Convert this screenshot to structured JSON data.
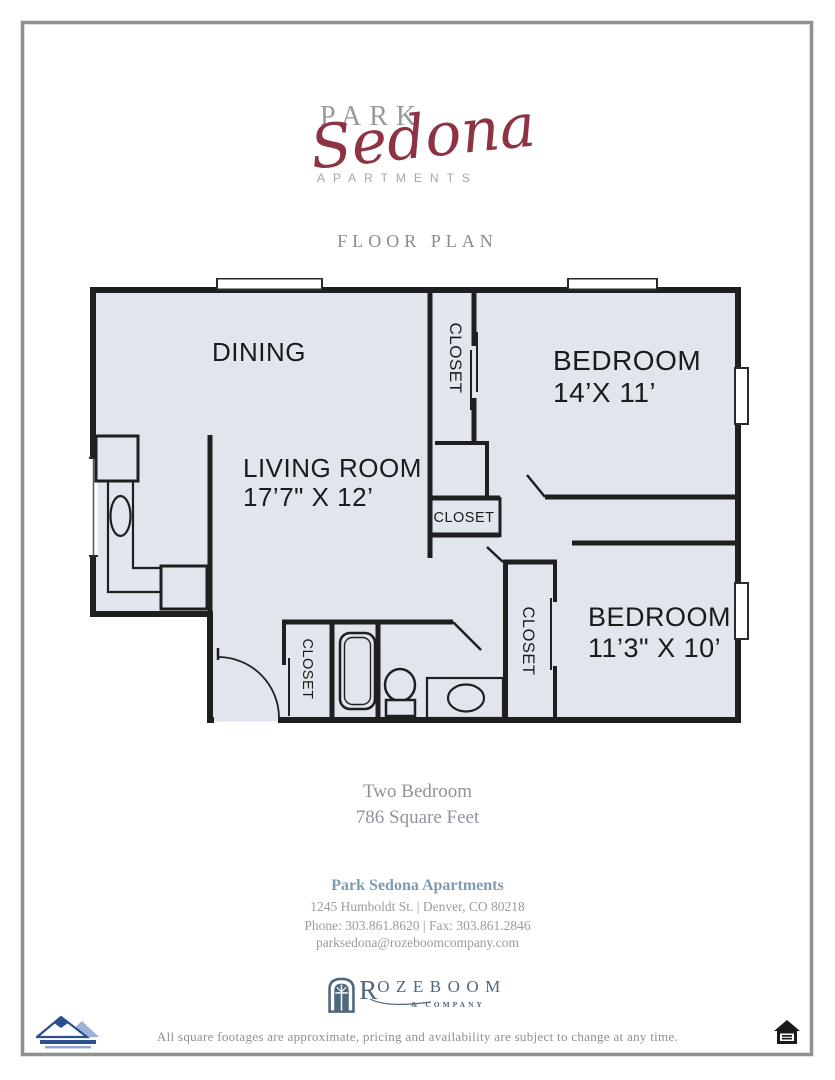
{
  "brand": {
    "line1": "PARK",
    "script": "Sedona",
    "line2": "APARTMENTS"
  },
  "heading": "FLOOR PLAN",
  "plan": {
    "closet_label": "CLOSET",
    "dining": "DINING",
    "living": {
      "name": "LIVING ROOM",
      "dims": "17’7\" X 12’"
    },
    "bedroom1": {
      "name": "BEDROOM",
      "dims": "14’X 11’"
    },
    "bedroom2": {
      "name": "BEDROOM",
      "dims": "11’3\" X 10’"
    }
  },
  "summary": {
    "type": "Two Bedroom",
    "area": "786 Square Feet"
  },
  "contact": {
    "name": "Park Sedona Apartments",
    "address": "1245 Humboldt St.  |  Denver, CO 80218",
    "phone_fax": "Phone: 303.861.8620  |  Fax: 303.861.2846",
    "email": "parksedona@rozeboomcompany.com"
  },
  "company_logo": {
    "name_initial": "R",
    "name_rest": "OZEBOOM",
    "tagline": "& COMPANY"
  },
  "disclaimer": "All square footages are approximate, pricing and availability are subject to change at any time.",
  "colors": {
    "accent_red": "#8e3344",
    "brand_gray": "#97999b",
    "contact_blue": "#7f9bb1",
    "logo_slate": "#4e6880",
    "floor_fill": "#e1e6ee",
    "wall": "#1f1f1f"
  }
}
